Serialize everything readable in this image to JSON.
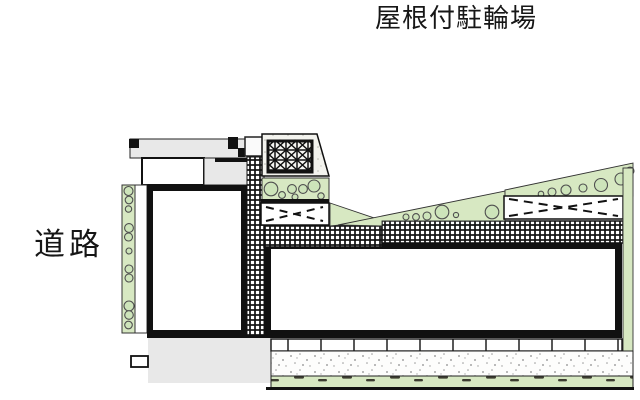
{
  "labels": {
    "road": "道路",
    "covered_bicycle_parking": "屋根付駐輪場"
  },
  "colors": {
    "planting_green": "#d7e8c2",
    "bush_green": "#cde4ba",
    "hardscape_gray": "#e8e8e8",
    "drawing_line": "#111111",
    "background": "#ffffff"
  }
}
